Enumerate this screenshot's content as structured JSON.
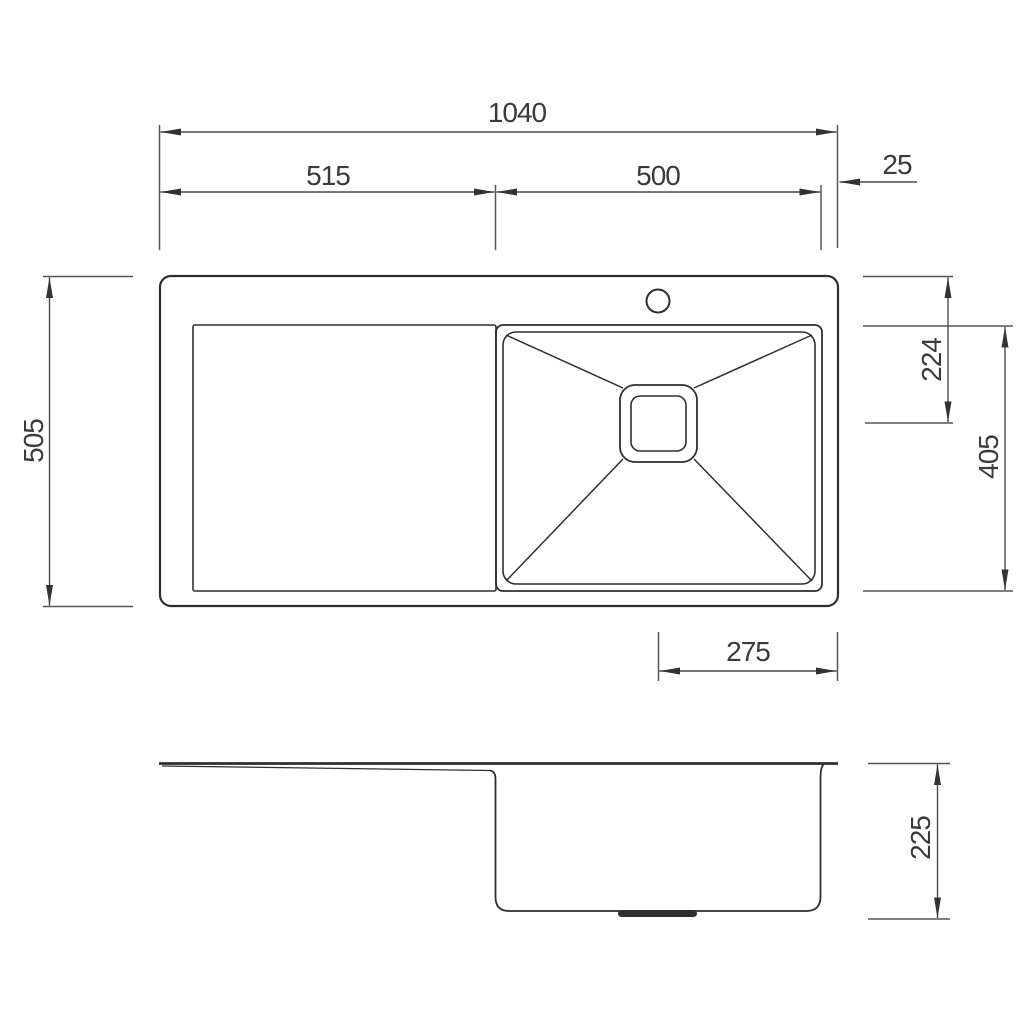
{
  "drawing": {
    "background_color": "#ffffff",
    "line_color": "#2f2f2f",
    "dimension_line_color": "#4a4a4a",
    "label_color": "#3a3a3a",
    "top_view": {
      "dimensions": {
        "overall_width": "1040",
        "drainboard_width": "515",
        "bowl_width": "500",
        "right_rim": "25",
        "overall_depth": "505",
        "drain_center_from_back": "224",
        "bowl_front_to_back": "405",
        "drain_center_to_right_edge": "275"
      }
    },
    "side_view": {
      "dimensions": {
        "bowl_depth": "225"
      }
    }
  }
}
